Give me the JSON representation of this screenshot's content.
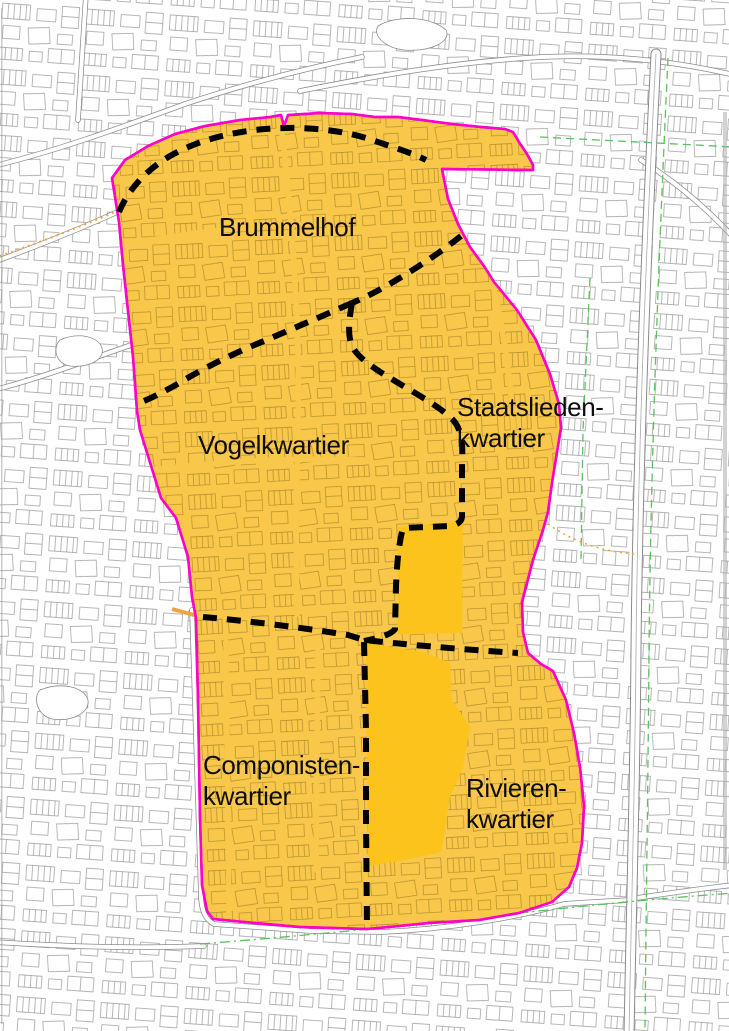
{
  "map": {
    "description": "Neighbourhood plan map with highlighted plan area and dashed district boundaries",
    "districts": [
      {
        "id": "brummelhof",
        "label": "Brummelhof"
      },
      {
        "id": "vogelkwartier",
        "label": "Vogelkwartier"
      },
      {
        "id": "staatsliedenkwartier",
        "label_line1": "Staatslieden-",
        "label_line2": "kwartier"
      },
      {
        "id": "componistenkwartier",
        "label_line1": "Componisten-",
        "label_line2": "kwartier"
      },
      {
        "id": "rivierenkwartier",
        "label_line1": "Rivieren-",
        "label_line2": "kwartier"
      }
    ],
    "colors": {
      "highlight_area": "#F9C749",
      "highlight_block": "#FBC31C",
      "boundary_outline": "#FF00CC",
      "district_divider": "#000000",
      "background_lines": "#8a8a8a",
      "green_route_line": "#5DC05D",
      "orange_route_line": "#F2A33C"
    }
  }
}
